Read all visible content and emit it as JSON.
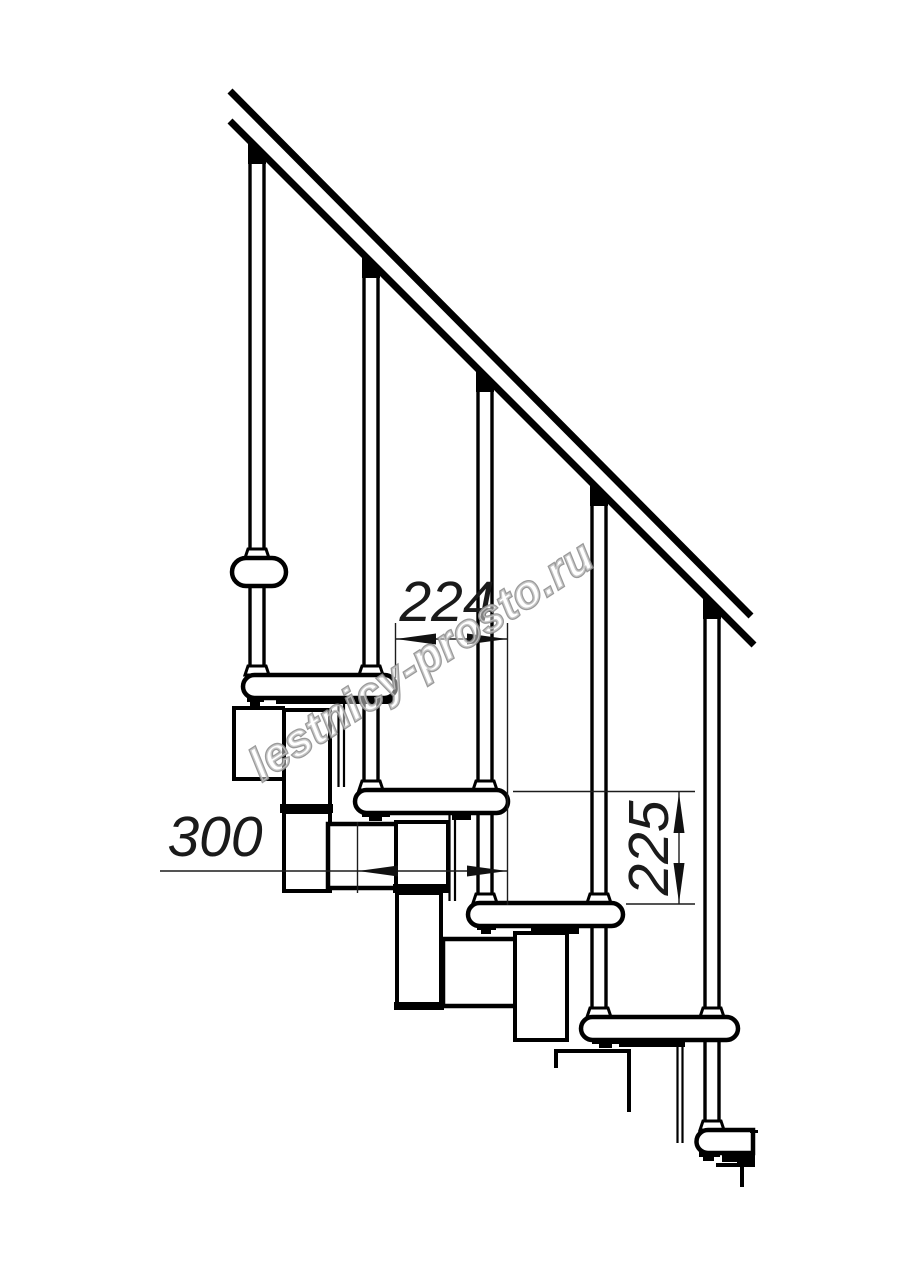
{
  "drawing": {
    "watermark": "lestnicy-prosto.ru",
    "dimensions": {
      "step_run": {
        "label": "224"
      },
      "tread_depth": {
        "label": "300"
      },
      "step_rise": {
        "label": "225"
      }
    },
    "colors": {
      "ink": "#000000",
      "dimension_line": "#1c1c1c",
      "watermark_outline": "#8f8f8f",
      "background": "#ffffff"
    }
  }
}
